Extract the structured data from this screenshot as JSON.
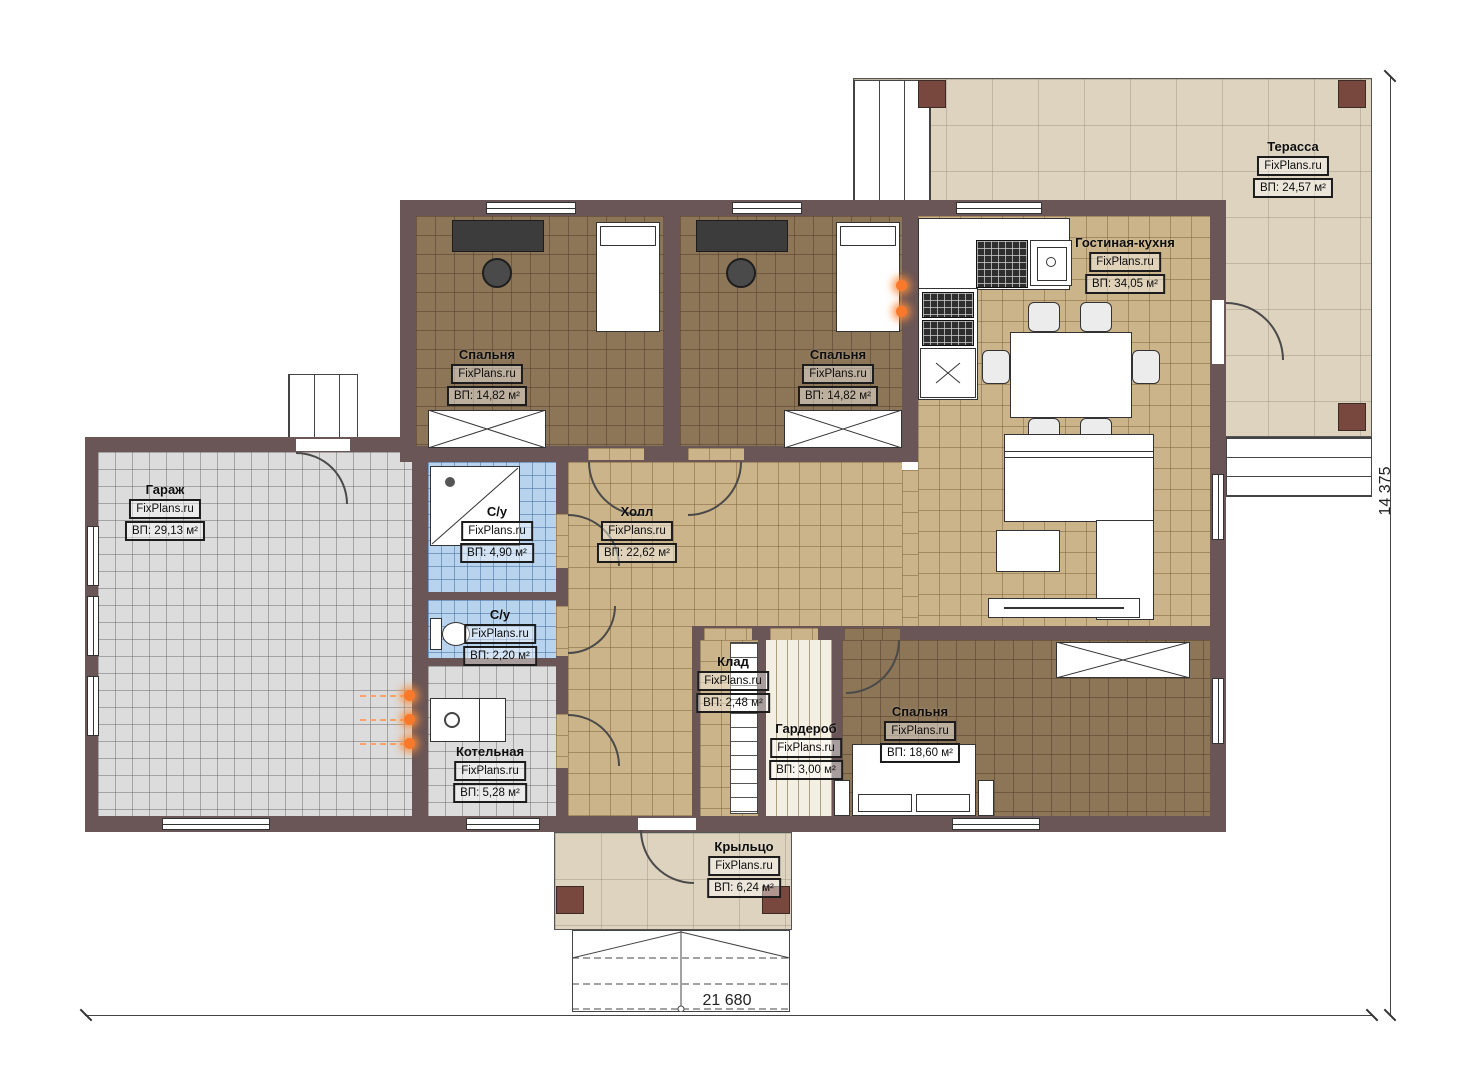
{
  "brand": "FixPlans.ru",
  "dimensions": {
    "width_label": "21 680",
    "height_label": "14 375"
  },
  "rooms": {
    "terrace": {
      "name": "Терасса",
      "brand": "FixPlans.ru",
      "area": "ВП: 24,57 м²"
    },
    "living_kitchen": {
      "name": "Гостиная-кухня",
      "brand": "FixPlans.ru",
      "area": "ВП: 34,05 м²"
    },
    "bedroom_1": {
      "name": "Спальня",
      "brand": "FixPlans.ru",
      "area": "ВП: 14,82 м²"
    },
    "bedroom_2": {
      "name": "Спальня",
      "brand": "FixPlans.ru",
      "area": "ВП: 14,82 м²"
    },
    "garage": {
      "name": "Гараж",
      "brand": "FixPlans.ru",
      "area": "ВП: 29,13 м²"
    },
    "bathroom_1": {
      "name": "С/у",
      "brand": "FixPlans.ru",
      "area": "ВП: 4,90 м²"
    },
    "hall": {
      "name": "Холл",
      "brand": "FixPlans.ru",
      "area": "ВП: 22,62 м²"
    },
    "bathroom_2": {
      "name": "С/у",
      "brand": "FixPlans.ru",
      "area": "ВП: 2,20 м²"
    },
    "storage": {
      "name": "Клад",
      "brand": "FixPlans.ru",
      "area": "ВП: 2,48 м²"
    },
    "wardrobe": {
      "name": "Гардероб",
      "brand": "FixPlans.ru",
      "area": "ВП: 3,00 м²"
    },
    "bedroom_3": {
      "name": "Спальня",
      "brand": "FixPlans.ru",
      "area": "ВП: 18,60 м²"
    },
    "boiler": {
      "name": "Котельная",
      "brand": "FixPlans.ru",
      "area": "ВП: 5,28 м²"
    },
    "porch": {
      "name": "Крыльцо",
      "brand": "FixPlans.ru",
      "area": "ВП: 6,24 м²"
    }
  },
  "colors": {
    "wall": "#6a5656",
    "floor_bedroom": "#8d7557",
    "floor_tile_tan": "#cbb489",
    "floor_tile_blue": "#b7d3ee",
    "floor_tile_gray": "#dcdcdc",
    "terrace_beige": "#ddd3bf",
    "column_brown": "#78473e",
    "utility_orange": "#f9792b"
  }
}
